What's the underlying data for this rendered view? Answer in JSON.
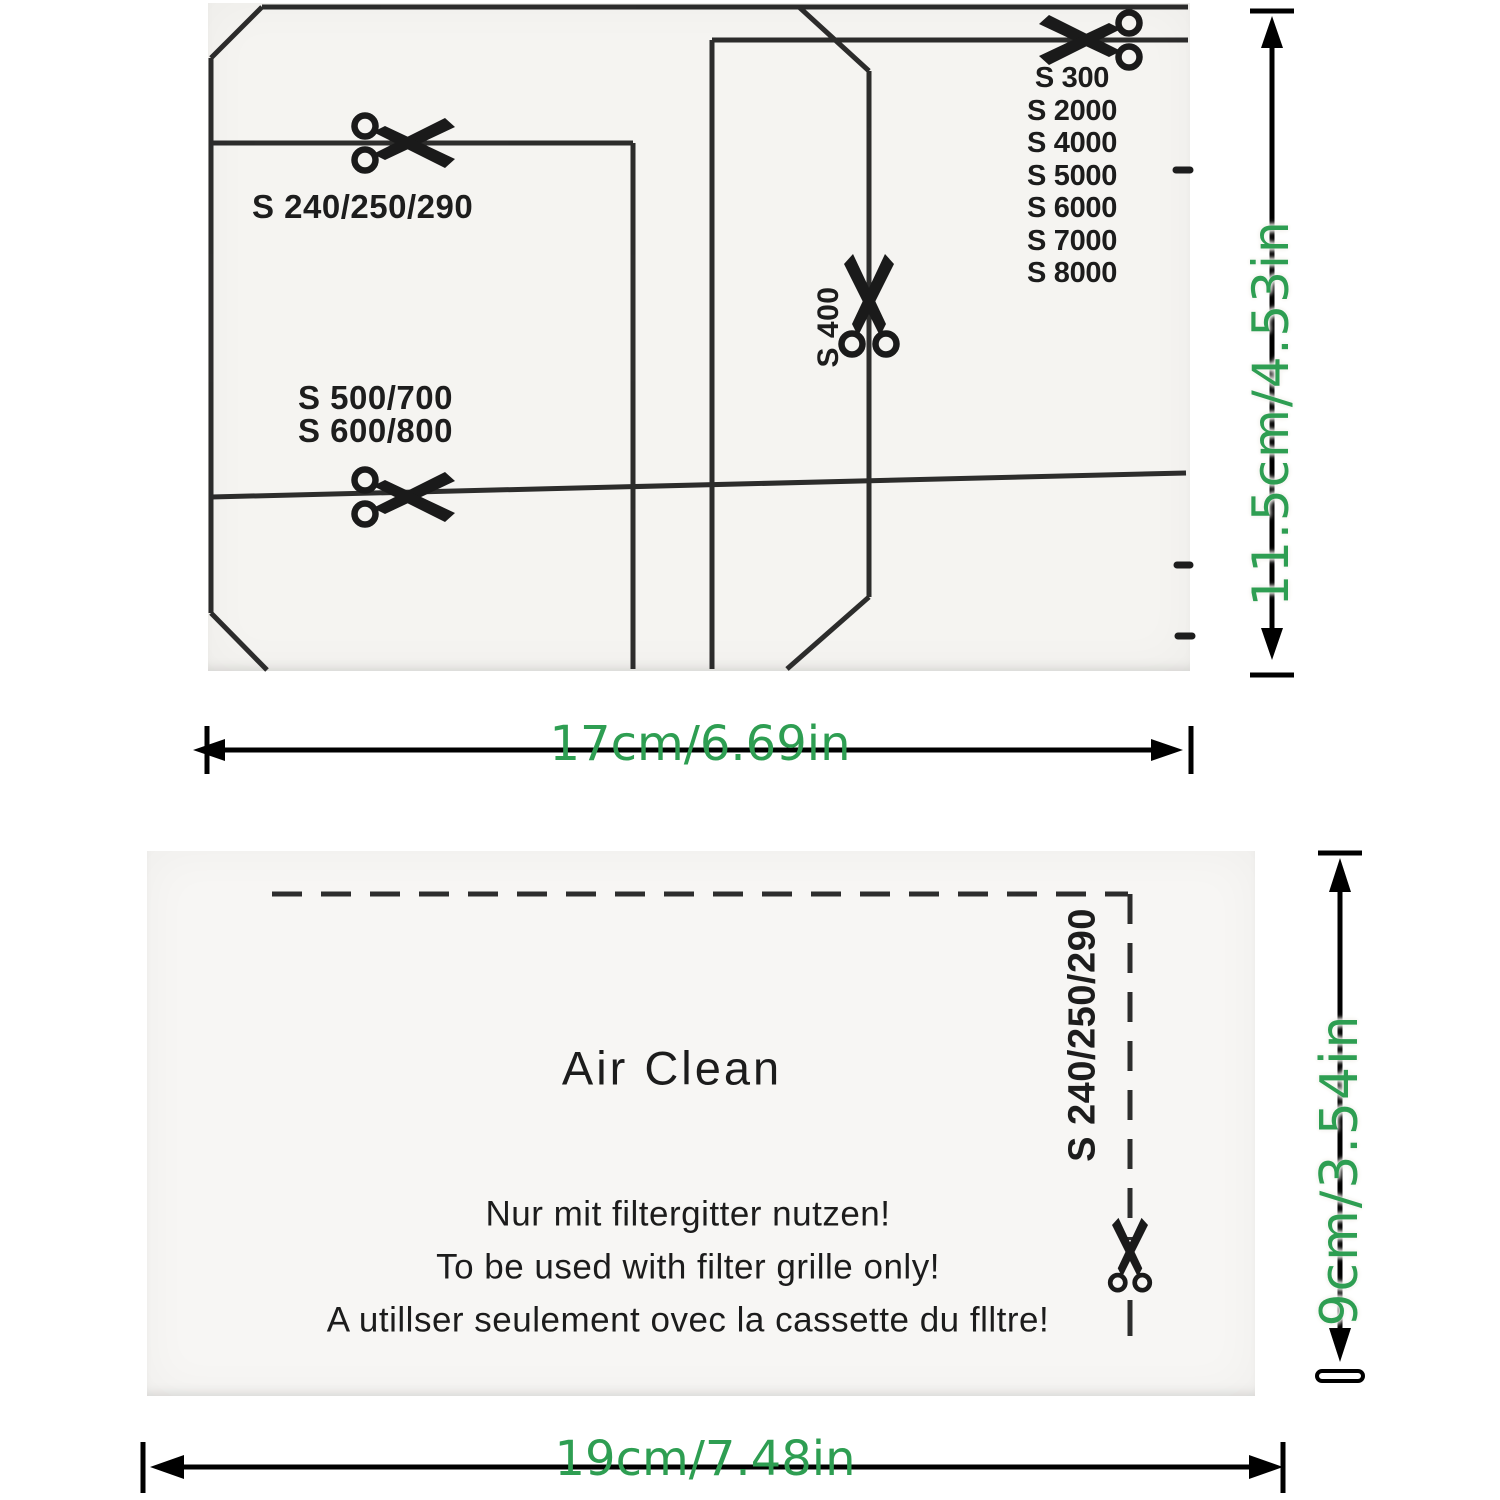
{
  "colors": {
    "green": "#2e9e52",
    "ink": "#1c1c1c"
  },
  "top_diagram": {
    "cut_label_1": "S 240/250/290",
    "cut_label_2a": "S 500/700",
    "cut_label_2b": "S 600/800",
    "cut_label_vertical": "S 400",
    "model_list": [
      "S 300",
      "S 2000",
      "S 4000",
      "S 5000",
      "S 6000",
      "S 7000",
      "S 8000"
    ],
    "height_dimension": "11.5cm/4.53in",
    "width_dimension": "17cm/6.69in"
  },
  "bottom_diagram": {
    "title": "Air Clean",
    "note_de": "Nur mit filtergitter nutzen!",
    "note_en": "To be used with filter grille only!",
    "note_fr": "A utillser seulement ovec la cassette du flltre!",
    "cut_label": "S 240/250/290",
    "height_dimension": "9cm/3.54in",
    "width_dimension": "19cm/7.48in"
  }
}
